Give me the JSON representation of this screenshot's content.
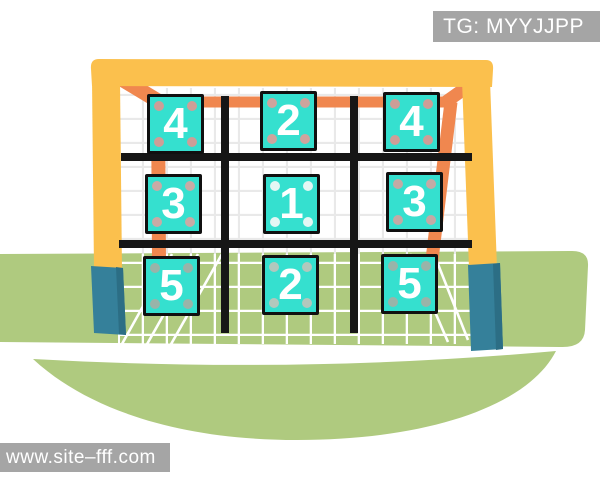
{
  "scene": {
    "grid_cells": [
      {
        "row": 1,
        "col": 1,
        "label": "4",
        "dot_color": "#d79a93"
      },
      {
        "row": 1,
        "col": 2,
        "label": "2",
        "dot_color": "#d7a09a"
      },
      {
        "row": 1,
        "col": 3,
        "label": "4",
        "dot_color": "#d79a93"
      },
      {
        "row": 2,
        "col": 1,
        "label": "3",
        "dot_color": "#d2a7a2"
      },
      {
        "row": 2,
        "col": 2,
        "label": "1",
        "dot_color": "#eef8f5"
      },
      {
        "row": 2,
        "col": 3,
        "label": "3",
        "dot_color": "#cba6a2"
      },
      {
        "row": 3,
        "col": 1,
        "label": "5",
        "dot_color": "#9fb1a6"
      },
      {
        "row": 3,
        "col": 2,
        "label": "2",
        "dot_color": "#b9c6bc"
      },
      {
        "row": 3,
        "col": 3,
        "label": "5",
        "dot_color": "#9fb1a6"
      }
    ],
    "colors": {
      "goal_frame_yellow": "#fbc04d",
      "goal_frame_orange": "#f0874f",
      "post_base_teal": "#35809a",
      "post_base_shade": "#2c6e85",
      "tile_cyan": "#35e0cf",
      "grass_green": "#afca7f",
      "grid_line_black": "#161616",
      "label_bg_gray": "#a5a5a5",
      "tile_number_white": "#ffffff"
    }
  },
  "overlays": {
    "tag_label": "TG: MYYJJPP",
    "watermark": "www.site–fff.com"
  }
}
